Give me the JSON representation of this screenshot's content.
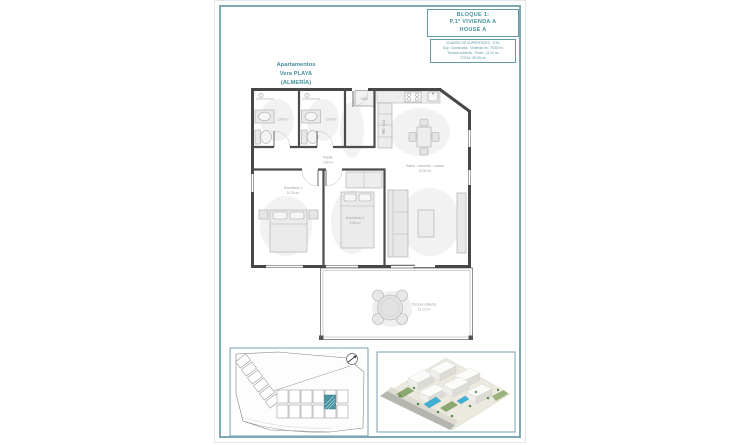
{
  "title_block": {
    "line1": "BLOQUE 1:",
    "line2": "P.1ª VIVIENDA A",
    "line3": "HOUSE A"
  },
  "surface_table": {
    "title": "CUADRO DE SUPERFICIES - ÚTIL",
    "row1": "Sup. Construida - Vivienda m²: 75.93 m²",
    "row2": "Terraza cubierta - Porch: 13.12 m²",
    "row3": "TOTAL: 89.05 m²"
  },
  "project_label": {
    "line1": "Apartamentos",
    "line2": "Vera PLAYA",
    "line3": "(ALMERÍA)"
  },
  "floor_plan": {
    "bath1_area": "3.95 m²",
    "bath2_area": "3.60 m²",
    "hall_name": "Pasillo",
    "hall_area": "2.85 m²",
    "bedroom1_name": "Dormitorio 1",
    "bedroom1_area": "10.25 m²",
    "bedroom2_name": "Dormitorio 2",
    "bedroom2_area": "9.85 m²",
    "living_name": "Salón - comedor - cocina",
    "living_area": "23.90 m²",
    "terrace_name": "Terraza cubierta",
    "terrace_area": "13.12 m²",
    "laundry_label": "LVD",
    "appliance_label": "FRI · LVJ"
  },
  "colors": {
    "teal_text": "#47919e",
    "frame_teal": "#7fa9b2",
    "wall_dark": "#474747",
    "site_highlight": "#4a96a4",
    "pool_blue": "#3fb0d4"
  }
}
